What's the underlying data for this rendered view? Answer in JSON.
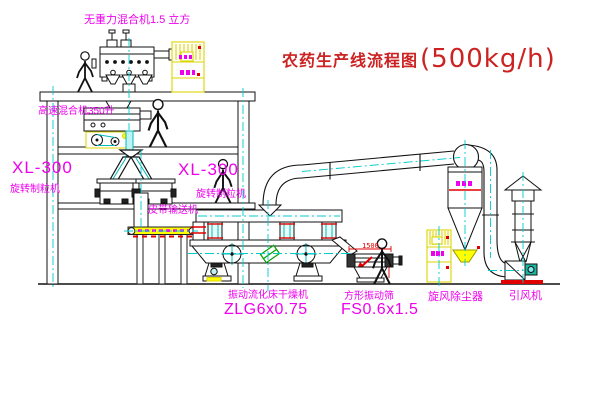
{
  "title": {
    "name": "农药生产线流程图",
    "capacity": "(500kg/h)"
  },
  "labels": {
    "gravity_mixer": "无重力混合机1.5 立方",
    "high_speed_mixer": "高速混合机350升",
    "granulator_left_model": "XL-300",
    "granulator_left_name": "旋转制粒机",
    "granulator_right_model": "XL-300",
    "granulator_right_name": "旋转制粒机",
    "belt_conveyor": "皮带输送机",
    "dryer_name": "振动流化床干燥机",
    "dryer_model": "ZLG6x0.75",
    "sieve_name": "方形振动筛",
    "sieve_model": "FS0.6x1.5",
    "cyclone": "旋风除尘器",
    "fan": "引风机"
  },
  "dimensions": {
    "sieve_length_mm": "1500"
  },
  "colors": {
    "label_magenta": "#ee00ee",
    "title_red": "#cc2222",
    "centerline_cyan": "#00cccc",
    "highlight_yellow": "#ffff00",
    "line_black": "#000000"
  }
}
